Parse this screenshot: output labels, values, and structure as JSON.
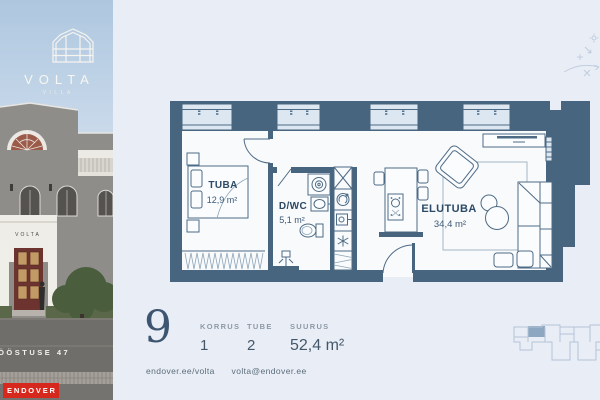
{
  "brand": {
    "logo_title": "VOLTA",
    "logo_subtitle": "VILLA",
    "building_sign": "VOLTA",
    "street_label": "TÖÖSTUSE 47",
    "endover_logo": "ENDOVER"
  },
  "floorplan": {
    "rooms": [
      {
        "name": "TUBA",
        "area": "12,9 m²"
      },
      {
        "name": "D/WC",
        "area": "5,1 m²"
      },
      {
        "name": "ELUTUBA",
        "area": "34,4 m²"
      }
    ]
  },
  "info": {
    "apartment_number": "9",
    "fields": [
      {
        "label": "KORRUS",
        "value": "1"
      },
      {
        "label": "TUBE",
        "value": "2"
      },
      {
        "label": "SUURUS",
        "value": "52,4 m²"
      }
    ],
    "website": "endover.ee/volta",
    "email": "volta@endover.ee"
  },
  "colors": {
    "wall": "#47657f",
    "endover_red": "#d7281d",
    "background": "#e9eef6"
  }
}
